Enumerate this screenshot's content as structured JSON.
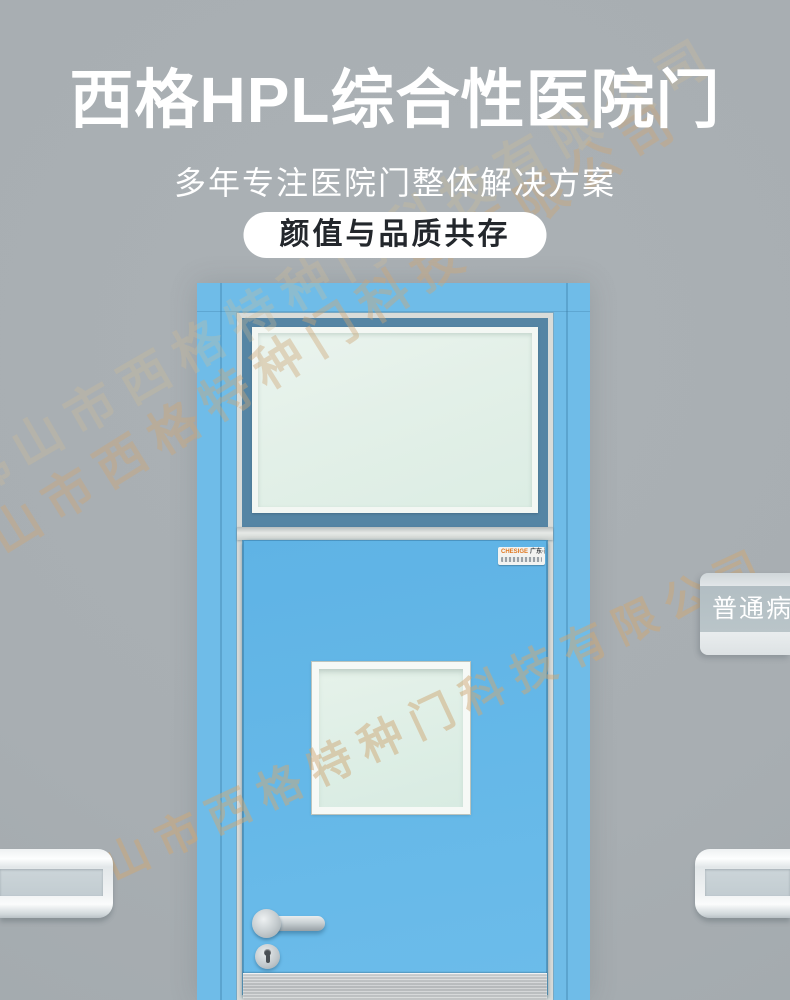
{
  "header": {
    "title": "西格HPL综合性医院门",
    "subtitle": "多年专注医院门整体解决方案",
    "badge": "颜值与品质共存"
  },
  "watermark": {
    "company": "佛山市西格特种门科技有限公司",
    "color": "#cea876"
  },
  "door": {
    "frame_color": "#6fbce8",
    "transom_frame_color": "#5585a4",
    "leaf_color": "#65b8e8",
    "glass_color": "#e3f0e8",
    "trim_color": "#d9dcd9",
    "kickplate_color": "#c6c9cb",
    "brand_label": {
      "logo": "CHESIGE",
      "name": "广东·西格"
    }
  },
  "room_sign": {
    "text": "普通病房",
    "band_color": "#b6c1c5",
    "text_color": "#ffffff"
  },
  "colors": {
    "wall": "#a9b0b4",
    "header_text": "#ffffff",
    "badge_bg": "#ffffff",
    "badge_text": "#23272c"
  }
}
